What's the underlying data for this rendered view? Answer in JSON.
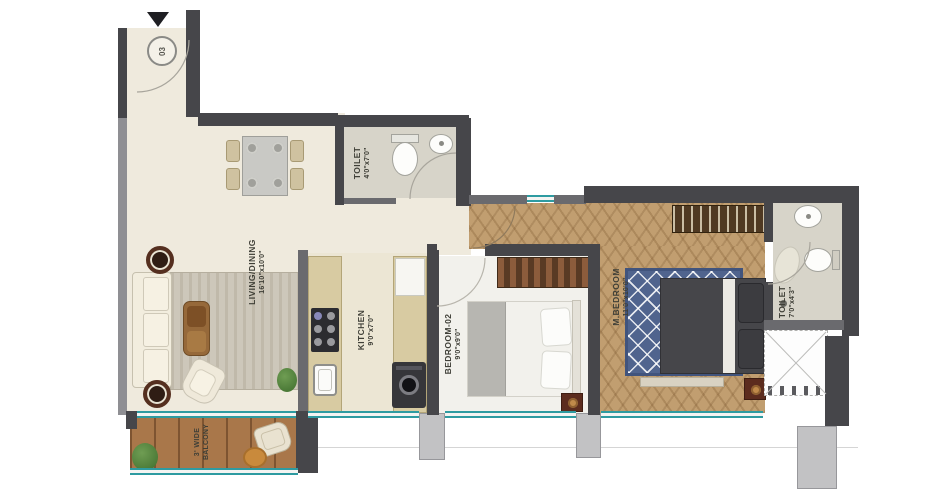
{
  "unit": {
    "number": "03"
  },
  "rooms": {
    "living": {
      "name": "LIVING/DINING",
      "dims": "16'10\"x10'0\""
    },
    "toilet1": {
      "name": "TOILET",
      "dims": "4'0\"x7'0\""
    },
    "kitchen": {
      "name": "KITCHEN",
      "dims": "9'0\"x7'0\""
    },
    "bedroom2": {
      "name": "BEDROOM-02",
      "dims": "9'0\"x9'0\""
    },
    "mbedroom": {
      "name": "M.BEDROOM",
      "dims": "11'0\"x10'0\""
    },
    "toilet2": {
      "name": "TOILET",
      "dims": "7'0\"x4'3\""
    },
    "balcony": {
      "name": "3' WIDE",
      "dims": "BALCONY"
    }
  },
  "colors": {
    "wall_dark": "#46464a",
    "glazing_teal": "#2e9ba1",
    "floor_cream": "#efeadd",
    "floor_wood": "#c19e70",
    "balcony_wood": "#a9774a",
    "rug_blue": "#50648e",
    "label_text": "#3f3f37"
  }
}
